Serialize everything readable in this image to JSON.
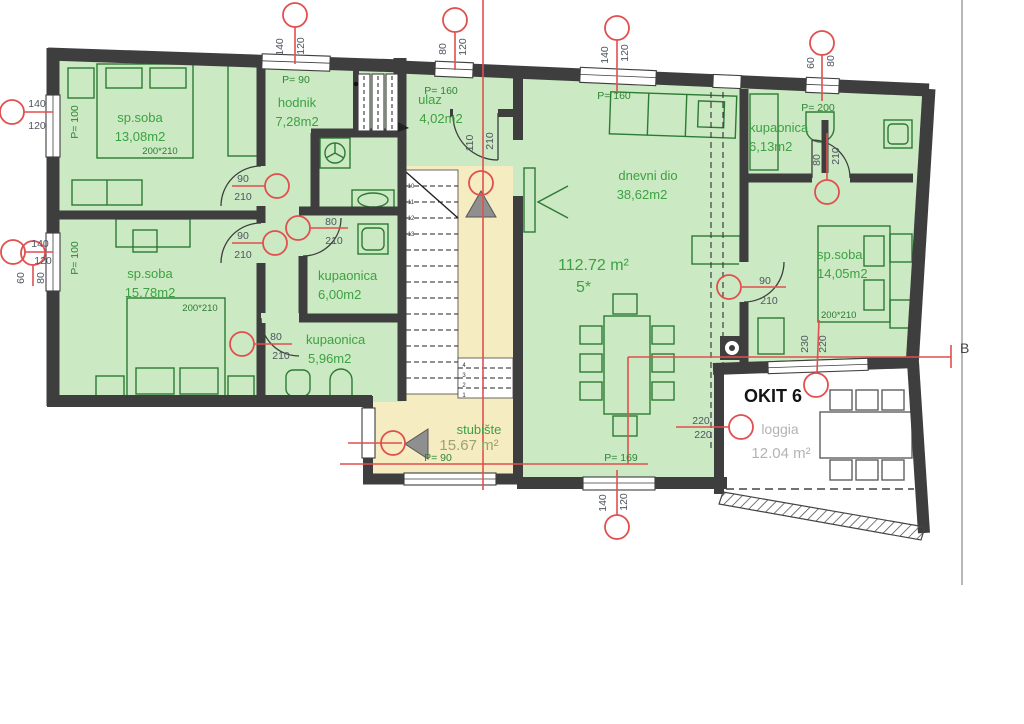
{
  "plan": {
    "unit": {
      "name": "OKIT 6",
      "total_area": "112.72 m²",
      "type_label": "5*"
    },
    "section_label": "B",
    "rooms": [
      {
        "name": "sp.soba",
        "area": "13,08m2"
      },
      {
        "name": "sp.soba",
        "area": "15,78m2"
      },
      {
        "name": "hodnik",
        "area": "7,28m2"
      },
      {
        "name": "ulaz",
        "area": "4,02m2"
      },
      {
        "name": "dnevni dio",
        "area": "38,62m2"
      },
      {
        "name": "kupaonica",
        "area": "6,00m2"
      },
      {
        "name": "kupaonica",
        "area": "5,96m2"
      },
      {
        "name": "kupaonica",
        "area": "6,13m2"
      },
      {
        "name": "sp.soba",
        "area": "14,05m2"
      },
      {
        "name": "stubište",
        "area": "15.67 m²"
      },
      {
        "name": "loggia",
        "area": "12.04 m²"
      }
    ],
    "bed_sizes": [
      "200*210",
      "200*210",
      "200*210"
    ],
    "windows": [
      {
        "w": "140",
        "h": "120",
        "p": "P= 90"
      },
      {
        "w": "80",
        "h": "120",
        "p": "P= 160"
      },
      {
        "w": "140",
        "h": "120",
        "p": "P= 160"
      },
      {
        "w": "60",
        "h": "80",
        "p": "P= 200"
      },
      {
        "w": "140",
        "h": "120",
        "p": "P= 100"
      },
      {
        "w": "140",
        "h": "120",
        "p": "P= 100"
      },
      {
        "w": "60",
        "h": "80"
      },
      {
        "w": "140",
        "h": "120",
        "p": "P= 169"
      },
      {
        "p": "P= 90"
      },
      {
        "w": "230",
        "h": "220"
      },
      {
        "w": "220",
        "h": "220"
      }
    ],
    "doors": [
      {
        "w": "90",
        "h": "210"
      },
      {
        "w": "90",
        "h": "210"
      },
      {
        "w": "80",
        "h": "210"
      },
      {
        "w": "80",
        "h": "210"
      },
      {
        "w": "90",
        "h": "210"
      },
      {
        "w": "80",
        "h": "210"
      },
      {
        "w": "110",
        "h": "210"
      }
    ],
    "stairs": {
      "upper_numbers": [
        "10",
        "11",
        "12",
        "13"
      ],
      "lower_numbers": [
        "4",
        "3",
        "2",
        "1"
      ]
    }
  }
}
